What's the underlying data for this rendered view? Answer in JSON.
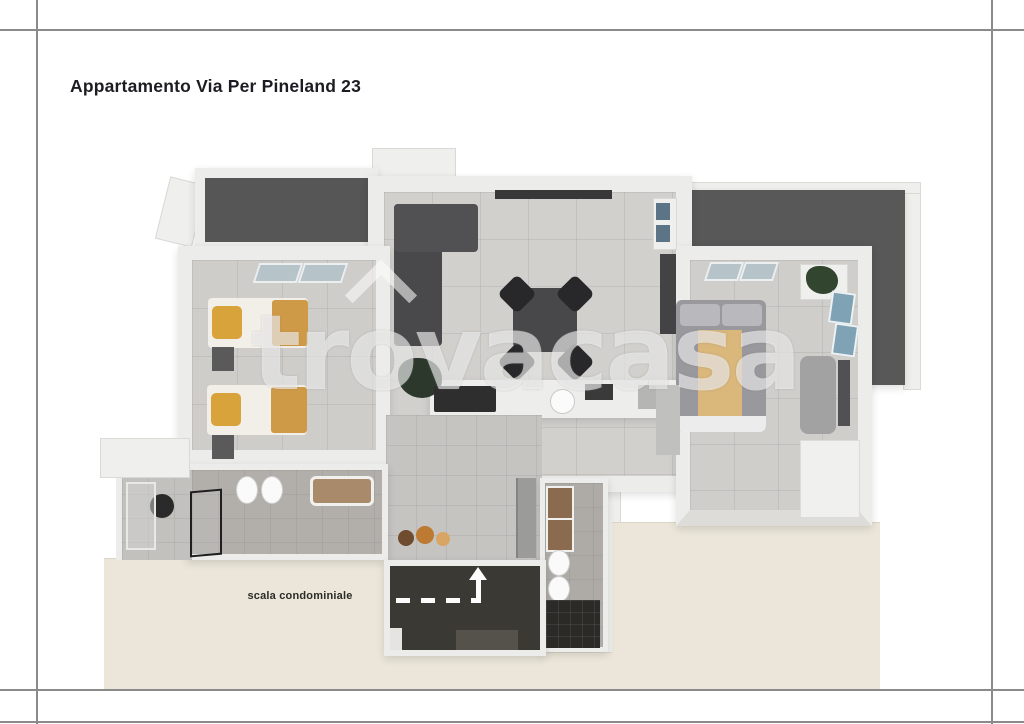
{
  "page": {
    "title": "Appartamento Via Per Pineland 23"
  },
  "watermark": {
    "text": "trovacasa",
    "part1": "tr",
    "part2": "o",
    "part3": "vacasa"
  },
  "labels": {
    "scala": "scala condominiale"
  },
  "colors": {
    "title_text": "#1c1c22",
    "frame_line": "#8a8a8a",
    "terrace_dark": "#585858",
    "stairwell_dark": "#3b3934",
    "outdoor_beige": "#ebe6d9",
    "floor_tile_gray": "#d2d0cd",
    "bath_tile_gray": "#b2afab",
    "pillow_yellow": "#d9a33c",
    "blanket_tan": "#cf9a47",
    "bed_runner_tan": "#dab77b",
    "sofa_gray": "#4a4a4c",
    "window_blue": "#9fb6c0"
  }
}
